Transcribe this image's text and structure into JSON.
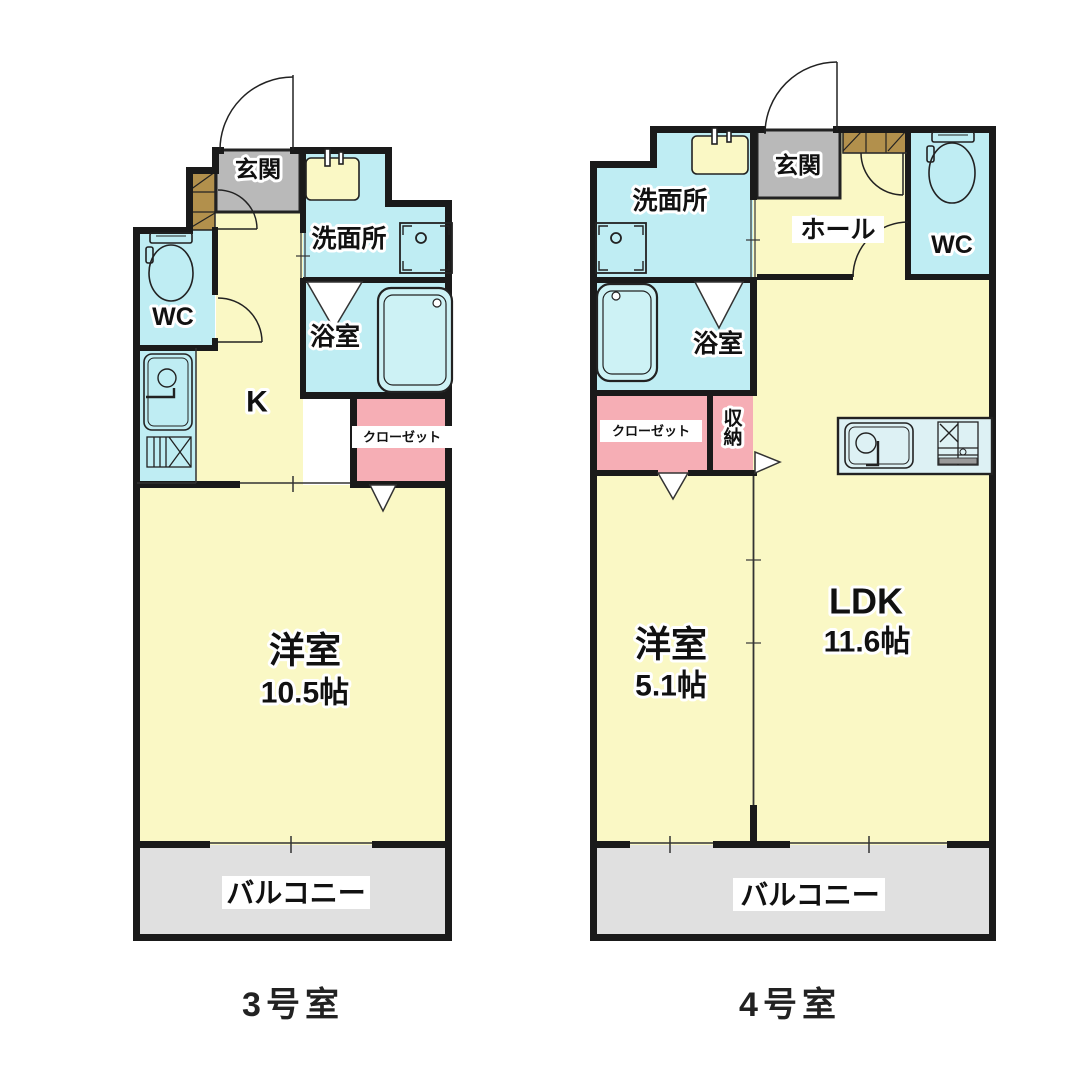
{
  "plan": {
    "type": "floor-plan",
    "colors": {
      "room_yellow": "#FAF8C5",
      "wet_cyan": "#BFEDF3",
      "closet_pink": "#F6AEB5",
      "entry_gray": "#B9B9B9",
      "balcony_gray": "#E0E0E0",
      "cabinet_brown": "#B2904C",
      "wall_black": "#1a1a1a"
    }
  },
  "unit3": {
    "caption": "3号室",
    "labels": {
      "genkan": "玄関",
      "senmenjo": "洗面所",
      "wc": "WC",
      "yokushitsu": "浴室",
      "kitchen": "K",
      "closet": "クローゼット",
      "room": "洋室",
      "room_size": "10.5帖",
      "balcony": "バルコニー"
    }
  },
  "unit4": {
    "caption": "4号室",
    "labels": {
      "senmenjo": "洗面所",
      "genkan": "玄関",
      "hall": "ホール",
      "wc": "WC",
      "yokushitsu": "浴室",
      "closet": "クローゼット",
      "storage": "収納",
      "ldk": "LDK",
      "ldk_size": "11.6帖",
      "room": "洋室",
      "room_size": "5.1帖",
      "balcony": "バルコニー"
    }
  }
}
